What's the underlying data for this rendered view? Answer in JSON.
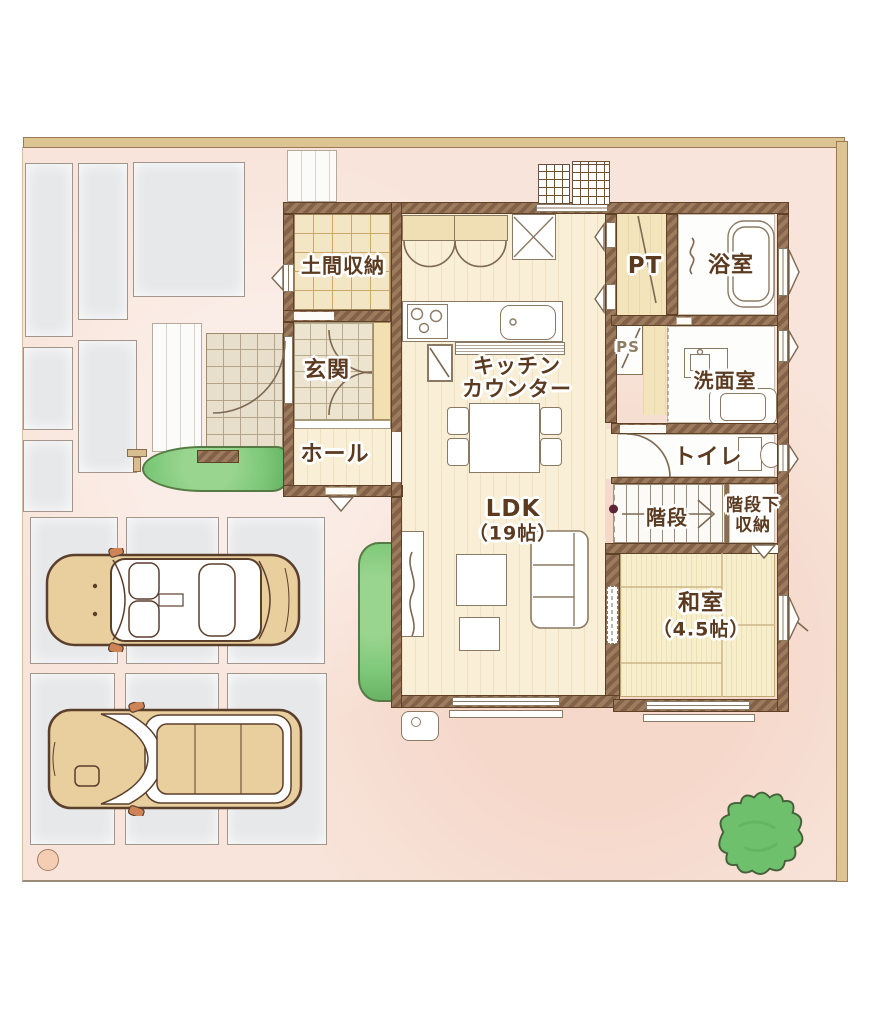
{
  "colors": {
    "site_background": "#f8e4da",
    "fence": "#dcc493",
    "wall_brown": "#8c6c50",
    "floor_wood": "#f9efd6",
    "tile_doma": "#f3e6c4",
    "tile_entrance": "#ece4cf",
    "tatami": "#f7eecb",
    "paving_slab": "#e7e8ea",
    "shrub_green": "#7cc878",
    "car_body": "#e8cf9d",
    "label_text": "#5b3a1f"
  },
  "rooms": {
    "doma_storage": {
      "label": "土間収納"
    },
    "entrance": {
      "label": "玄関"
    },
    "hall": {
      "label": "ホール"
    },
    "kitchen": {
      "line1": "キッチン",
      "line2": "カウンター"
    },
    "pantry": {
      "label": "PT"
    },
    "bathroom": {
      "label": "浴室"
    },
    "pipe_space": {
      "label": "PS"
    },
    "washroom": {
      "label": "洗面室"
    },
    "toilet": {
      "label": "トイレ"
    },
    "stairs": {
      "label": "階段"
    },
    "under_stairs_storage": {
      "line1": "階段下",
      "line2": "収納"
    },
    "ldk": {
      "line1": "LDK",
      "line2": "（19帖）"
    },
    "japanese_room": {
      "line1": "和室",
      "line2": "（4.5帖）"
    }
  }
}
